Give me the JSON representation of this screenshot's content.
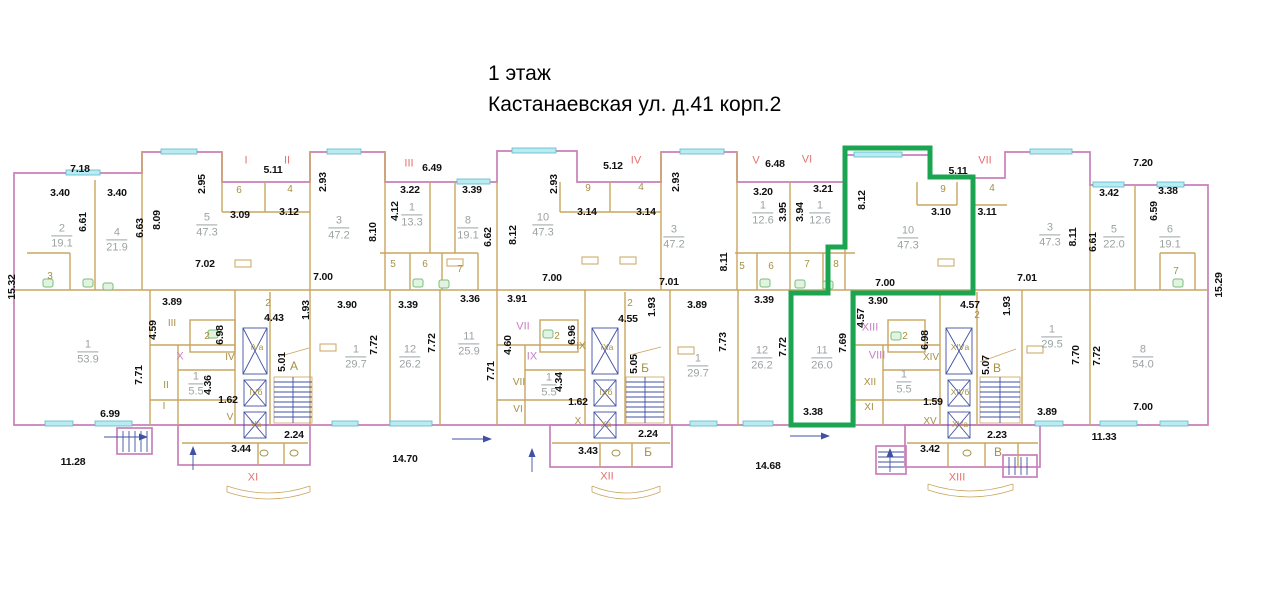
{
  "title": {
    "line1": "1 этаж",
    "line2": "Кастанаевская ул. д.41 корп.2"
  },
  "colors": {
    "outer_wall": "#c97fb9",
    "inner_wall": "#c9a55f",
    "window_fill": "#b8ecf2",
    "window_stroke": "#5fb7c8",
    "highlight": "#1ba551",
    "dim_text": "#111111",
    "room_text": "#9ba3a3",
    "olive_text": "#a59043",
    "red_text": "#e4716f",
    "mag_text": "#c77fc7",
    "blue": "#3f51a3",
    "fixture": "#7bbf7b"
  },
  "plan": {
    "labels": [
      {
        "c": "d",
        "t": "7.18",
        "x": 80,
        "y": 169
      },
      {
        "c": "d",
        "t": "3.40",
        "x": 60,
        "y": 193
      },
      {
        "c": "d",
        "t": "3.40",
        "x": 117,
        "y": 193
      },
      {
        "c": "d",
        "t": "6.61",
        "x": 83,
        "y": 222,
        "v": 1
      },
      {
        "c": "d",
        "t": "6.63",
        "x": 140,
        "y": 228,
        "v": 1
      },
      {
        "c": "d",
        "t": "8.09",
        "x": 157,
        "y": 220,
        "v": 1
      },
      {
        "c": "d",
        "t": "2.95",
        "x": 202,
        "y": 184,
        "v": 1
      },
      {
        "c": "d",
        "t": "3.09",
        "x": 240,
        "y": 215
      },
      {
        "c": "d",
        "t": "5.11",
        "x": 273,
        "y": 170
      },
      {
        "c": "d",
        "t": "3.12",
        "x": 289,
        "y": 212
      },
      {
        "c": "d",
        "t": "2.93",
        "x": 323,
        "y": 182,
        "v": 1
      },
      {
        "c": "d",
        "t": "8.10",
        "x": 373,
        "y": 232,
        "v": 1
      },
      {
        "c": "d",
        "t": "7.02",
        "x": 205,
        "y": 264
      },
      {
        "c": "d",
        "t": "7.00",
        "x": 323,
        "y": 277
      },
      {
        "c": "d",
        "t": "6.49",
        "x": 432,
        "y": 168
      },
      {
        "c": "d",
        "t": "3.22",
        "x": 410,
        "y": 190
      },
      {
        "c": "d",
        "t": "4.12",
        "x": 395,
        "y": 211,
        "v": 1
      },
      {
        "c": "d",
        "t": "3.39",
        "x": 472,
        "y": 190
      },
      {
        "c": "d",
        "t": "6.62",
        "x": 488,
        "y": 237,
        "v": 1
      },
      {
        "c": "d",
        "t": "8.12",
        "x": 513,
        "y": 235,
        "v": 1
      },
      {
        "c": "d",
        "t": "5.12",
        "x": 613,
        "y": 166
      },
      {
        "c": "d",
        "t": "2.93",
        "x": 554,
        "y": 184,
        "v": 1
      },
      {
        "c": "d",
        "t": "3.14",
        "x": 587,
        "y": 212
      },
      {
        "c": "d",
        "t": "3.14",
        "x": 646,
        "y": 212
      },
      {
        "c": "d",
        "t": "7.00",
        "x": 552,
        "y": 278
      },
      {
        "c": "d",
        "t": "2.93",
        "x": 676,
        "y": 182,
        "v": 1
      },
      {
        "c": "d",
        "t": "7.01",
        "x": 669,
        "y": 282
      },
      {
        "c": "d",
        "t": "8.11",
        "x": 724,
        "y": 262,
        "v": 1
      },
      {
        "c": "d",
        "t": "6.48",
        "x": 775,
        "y": 164
      },
      {
        "c": "d",
        "t": "3.20",
        "x": 763,
        "y": 192
      },
      {
        "c": "d",
        "t": "3.21",
        "x": 823,
        "y": 189
      },
      {
        "c": "d",
        "t": "3.95",
        "x": 783,
        "y": 212,
        "v": 1
      },
      {
        "c": "d",
        "t": "3.94",
        "x": 800,
        "y": 212,
        "v": 1
      },
      {
        "c": "d",
        "t": "8.12",
        "x": 862,
        "y": 200,
        "v": 1
      },
      {
        "c": "d",
        "t": "5.11",
        "x": 958,
        "y": 171
      },
      {
        "c": "d",
        "t": "3.10",
        "x": 941,
        "y": 212
      },
      {
        "c": "d",
        "t": "3.11",
        "x": 987,
        "y": 212
      },
      {
        "c": "d",
        "t": "7.00",
        "x": 885,
        "y": 283
      },
      {
        "c": "d",
        "t": "7.20",
        "x": 1143,
        "y": 163
      },
      {
        "c": "d",
        "t": "3.42",
        "x": 1109,
        "y": 193
      },
      {
        "c": "d",
        "t": "3.38",
        "x": 1168,
        "y": 191
      },
      {
        "c": "d",
        "t": "6.61",
        "x": 1093,
        "y": 242,
        "v": 1
      },
      {
        "c": "d",
        "t": "8.11",
        "x": 1073,
        "y": 237,
        "v": 1
      },
      {
        "c": "d",
        "t": "6.59",
        "x": 1154,
        "y": 211,
        "v": 1
      },
      {
        "c": "d",
        "t": "7.01",
        "x": 1027,
        "y": 278
      },
      {
        "c": "d",
        "t": "15.32",
        "x": 12,
        "y": 287,
        "v": 1
      },
      {
        "c": "d",
        "t": "15.29",
        "x": 1219,
        "y": 285,
        "v": 1
      },
      {
        "c": "d",
        "t": "3.89",
        "x": 172,
        "y": 302
      },
      {
        "c": "d",
        "t": "4.59",
        "x": 153,
        "y": 330,
        "v": 1
      },
      {
        "c": "d",
        "t": "7.71",
        "x": 139,
        "y": 375,
        "v": 1
      },
      {
        "c": "d",
        "t": "6.99",
        "x": 110,
        "y": 414
      },
      {
        "c": "d",
        "t": "11.28",
        "x": 73,
        "y": 462
      },
      {
        "c": "d",
        "t": "6.98",
        "x": 220,
        "y": 335,
        "v": 1
      },
      {
        "c": "d",
        "t": "4.36",
        "x": 208,
        "y": 385,
        "v": 1
      },
      {
        "c": "d",
        "t": "1.62",
        "x": 228,
        "y": 400
      },
      {
        "c": "d",
        "t": "3.44",
        "x": 241,
        "y": 449
      },
      {
        "c": "d",
        "t": "4.43",
        "x": 274,
        "y": 318
      },
      {
        "c": "d",
        "t": "1.93",
        "x": 306,
        "y": 310,
        "v": 1
      },
      {
        "c": "d",
        "t": "5.01",
        "x": 282,
        "y": 362,
        "v": 1
      },
      {
        "c": "d",
        "t": "2.24",
        "x": 294,
        "y": 435
      },
      {
        "c": "d",
        "t": "3.90",
        "x": 347,
        "y": 305
      },
      {
        "c": "d",
        "t": "7.72",
        "x": 374,
        "y": 345,
        "v": 1
      },
      {
        "c": "d",
        "t": "3.39",
        "x": 408,
        "y": 305
      },
      {
        "c": "d",
        "t": "7.72",
        "x": 432,
        "y": 343,
        "v": 1
      },
      {
        "c": "d",
        "t": "14.70",
        "x": 405,
        "y": 459
      },
      {
        "c": "d",
        "t": "3.36",
        "x": 470,
        "y": 299
      },
      {
        "c": "d",
        "t": "3.91",
        "x": 517,
        "y": 299
      },
      {
        "c": "d",
        "t": "7.71",
        "x": 491,
        "y": 371,
        "v": 1
      },
      {
        "c": "d",
        "t": "4.60",
        "x": 508,
        "y": 345,
        "v": 1
      },
      {
        "c": "d",
        "t": "4.34",
        "x": 559,
        "y": 382,
        "v": 1
      },
      {
        "c": "d",
        "t": "6.96",
        "x": 572,
        "y": 335,
        "v": 1
      },
      {
        "c": "d",
        "t": "1.62",
        "x": 578,
        "y": 402
      },
      {
        "c": "d",
        "t": "5.05",
        "x": 634,
        "y": 364,
        "v": 1
      },
      {
        "c": "d",
        "t": "4.55",
        "x": 628,
        "y": 319
      },
      {
        "c": "d",
        "t": "1.93",
        "x": 652,
        "y": 307,
        "v": 1
      },
      {
        "c": "d",
        "t": "2.24",
        "x": 648,
        "y": 434
      },
      {
        "c": "d",
        "t": "3.43",
        "x": 588,
        "y": 451
      },
      {
        "c": "d",
        "t": "3.89",
        "x": 697,
        "y": 305
      },
      {
        "c": "d",
        "t": "7.73",
        "x": 723,
        "y": 342,
        "v": 1
      },
      {
        "c": "d",
        "t": "3.39",
        "x": 764,
        "y": 300
      },
      {
        "c": "d",
        "t": "7.72",
        "x": 783,
        "y": 347,
        "v": 1
      },
      {
        "c": "d",
        "t": "7.69",
        "x": 843,
        "y": 343,
        "v": 1
      },
      {
        "c": "d",
        "t": "3.38",
        "x": 813,
        "y": 412
      },
      {
        "c": "d",
        "t": "3.90",
        "x": 878,
        "y": 301
      },
      {
        "c": "d",
        "t": "4.57",
        "x": 861,
        "y": 318,
        "v": 1
      },
      {
        "c": "d",
        "t": "6.98",
        "x": 925,
        "y": 340,
        "v": 1
      },
      {
        "c": "d",
        "t": "1.59",
        "x": 933,
        "y": 402
      },
      {
        "c": "d",
        "t": "3.42",
        "x": 930,
        "y": 449
      },
      {
        "c": "d",
        "t": "5.07",
        "x": 986,
        "y": 365,
        "v": 1
      },
      {
        "c": "d",
        "t": "2.23",
        "x": 997,
        "y": 435
      },
      {
        "c": "d",
        "t": "4.57",
        "x": 970,
        "y": 305
      },
      {
        "c": "d",
        "t": "1.93",
        "x": 1007,
        "y": 306,
        "v": 1
      },
      {
        "c": "d",
        "t": "3.89",
        "x": 1047,
        "y": 412
      },
      {
        "c": "d",
        "t": "7.70",
        "x": 1076,
        "y": 355,
        "v": 1
      },
      {
        "c": "d",
        "t": "7.72",
        "x": 1097,
        "y": 356,
        "v": 1
      },
      {
        "c": "d",
        "t": "7.00",
        "x": 1143,
        "y": 407
      },
      {
        "c": "d",
        "t": "11.33",
        "x": 1104,
        "y": 437
      },
      {
        "c": "d",
        "t": "14.68",
        "x": 768,
        "y": 466
      },
      {
        "c": "r",
        "n": "2",
        "a": "19.1",
        "x": 62,
        "y": 236
      },
      {
        "c": "r",
        "n": "4",
        "a": "21.9",
        "x": 117,
        "y": 240
      },
      {
        "c": "r",
        "n": "5",
        "a": "47.3",
        "x": 207,
        "y": 225
      },
      {
        "c": "r",
        "n": "3",
        "a": "47.2",
        "x": 339,
        "y": 228
      },
      {
        "c": "r",
        "n": "1",
        "a": "13.3",
        "x": 412,
        "y": 215
      },
      {
        "c": "r",
        "n": "8",
        "a": "19.1",
        "x": 468,
        "y": 228
      },
      {
        "c": "r",
        "n": "10",
        "a": "47.3",
        "x": 543,
        "y": 225
      },
      {
        "c": "r",
        "n": "3",
        "a": "47.2",
        "x": 674,
        "y": 237
      },
      {
        "c": "r",
        "n": "1",
        "a": "12.6",
        "x": 763,
        "y": 213
      },
      {
        "c": "r",
        "n": "1",
        "a": "12.6",
        "x": 820,
        "y": 213
      },
      {
        "c": "r",
        "n": "10",
        "a": "47.3",
        "x": 908,
        "y": 238
      },
      {
        "c": "r",
        "n": "3",
        "a": "47.3",
        "x": 1050,
        "y": 235
      },
      {
        "c": "r",
        "n": "5",
        "a": "22.0",
        "x": 1114,
        "y": 237
      },
      {
        "c": "r",
        "n": "6",
        "a": "19.1",
        "x": 1170,
        "y": 237
      },
      {
        "c": "r",
        "n": "1",
        "a": "53.9",
        "x": 88,
        "y": 352
      },
      {
        "c": "r",
        "n": "1",
        "a": "5.5",
        "x": 196,
        "y": 384
      },
      {
        "c": "r",
        "n": "1",
        "a": "29.7",
        "x": 356,
        "y": 357
      },
      {
        "c": "r",
        "n": "12",
        "a": "26.2",
        "x": 410,
        "y": 357
      },
      {
        "c": "r",
        "n": "11",
        "a": "25.9",
        "x": 469,
        "y": 344
      },
      {
        "c": "r",
        "n": "1",
        "a": "5.5",
        "x": 549,
        "y": 385
      },
      {
        "c": "r",
        "n": "1",
        "a": "29.7",
        "x": 698,
        "y": 366
      },
      {
        "c": "r",
        "n": "12",
        "a": "26.2",
        "x": 762,
        "y": 358
      },
      {
        "c": "r",
        "n": "11",
        "a": "26.0",
        "x": 822,
        "y": 358
      },
      {
        "c": "r",
        "n": "1",
        "a": "5.5",
        "x": 904,
        "y": 382
      },
      {
        "c": "r",
        "n": "1",
        "a": "29.5",
        "x": 1052,
        "y": 337
      },
      {
        "c": "r",
        "n": "8",
        "a": "54.0",
        "x": 1143,
        "y": 357
      },
      {
        "c": "s",
        "t": "6",
        "x": 239,
        "y": 191
      },
      {
        "c": "s",
        "t": "4",
        "x": 290,
        "y": 190
      },
      {
        "c": "s",
        "t": "3",
        "x": 50,
        "y": 277
      },
      {
        "c": "s",
        "t": "5",
        "x": 393,
        "y": 265
      },
      {
        "c": "s",
        "t": "6",
        "x": 425,
        "y": 265
      },
      {
        "c": "s",
        "t": "7",
        "x": 460,
        "y": 270
      },
      {
        "c": "s",
        "t": "9",
        "x": 588,
        "y": 189
      },
      {
        "c": "s",
        "t": "4",
        "x": 641,
        "y": 188
      },
      {
        "c": "s",
        "t": "5",
        "x": 742,
        "y": 267
      },
      {
        "c": "s",
        "t": "6",
        "x": 771,
        "y": 267
      },
      {
        "c": "s",
        "t": "7",
        "x": 807,
        "y": 265
      },
      {
        "c": "s",
        "t": "8",
        "x": 836,
        "y": 265
      },
      {
        "c": "s",
        "t": "9",
        "x": 943,
        "y": 190
      },
      {
        "c": "s",
        "t": "4",
        "x": 992,
        "y": 189
      },
      {
        "c": "s",
        "t": "7",
        "x": 1176,
        "y": 272
      },
      {
        "c": "s",
        "t": "2",
        "x": 207,
        "y": 337
      },
      {
        "c": "s",
        "t": "2",
        "x": 268,
        "y": 304
      },
      {
        "c": "s",
        "t": "2",
        "x": 557,
        "y": 337
      },
      {
        "c": "s",
        "t": "2",
        "x": 630,
        "y": 304
      },
      {
        "c": "s",
        "t": "2",
        "x": 905,
        "y": 337
      },
      {
        "c": "s",
        "t": "2",
        "x": 977,
        "y": 316
      },
      {
        "c": "s",
        "t": "III",
        "x": 172,
        "y": 324
      },
      {
        "c": "s",
        "t": "II",
        "x": 166,
        "y": 386
      },
      {
        "c": "s",
        "t": "I",
        "x": 164,
        "y": 407
      },
      {
        "c": "s",
        "t": "IV",
        "x": 230,
        "y": 358
      },
      {
        "c": "s",
        "t": "V",
        "x": 230,
        "y": 418
      },
      {
        "c": "s",
        "t": "VII",
        "x": 519,
        "y": 383
      },
      {
        "c": "s",
        "t": "VI",
        "x": 518,
        "y": 410
      },
      {
        "c": "s",
        "t": "IX",
        "x": 581,
        "y": 347
      },
      {
        "c": "s",
        "t": "X",
        "x": 578,
        "y": 422
      },
      {
        "c": "s",
        "t": "XII",
        "x": 870,
        "y": 383
      },
      {
        "c": "s",
        "t": "XI",
        "x": 869,
        "y": 408
      },
      {
        "c": "s",
        "t": "XIV",
        "x": 931,
        "y": 358
      },
      {
        "c": "s",
        "t": "XV",
        "x": 930,
        "y": 422
      },
      {
        "c": "st",
        "t": "А",
        "x": 294,
        "y": 366
      },
      {
        "c": "st",
        "t": "Б",
        "x": 645,
        "y": 368
      },
      {
        "c": "st",
        "t": "Б",
        "x": 648,
        "y": 452
      },
      {
        "c": "st",
        "t": "В",
        "x": 997,
        "y": 368
      },
      {
        "c": "st",
        "t": "В",
        "x": 998,
        "y": 452
      },
      {
        "c": "sh",
        "t": "IVа",
        "x": 257,
        "y": 347
      },
      {
        "c": "sh",
        "t": "IVб",
        "x": 256,
        "y": 392
      },
      {
        "c": "sh",
        "t": "Vа",
        "x": 256,
        "y": 424
      },
      {
        "c": "sh",
        "t": "IXа",
        "x": 607,
        "y": 347
      },
      {
        "c": "sh",
        "t": "IXб",
        "x": 606,
        "y": 392
      },
      {
        "c": "sh",
        "t": "Xа",
        "x": 606,
        "y": 424
      },
      {
        "c": "sh",
        "t": "XIVа",
        "x": 960,
        "y": 347
      },
      {
        "c": "sh",
        "t": "XIVб",
        "x": 960,
        "y": 392
      },
      {
        "c": "sh",
        "t": "XVа",
        "x": 960,
        "y": 424
      },
      {
        "c": "rr",
        "t": "I",
        "x": 246,
        "y": 161
      },
      {
        "c": "rr",
        "t": "II",
        "x": 287,
        "y": 161
      },
      {
        "c": "rr",
        "t": "III",
        "x": 409,
        "y": 164
      },
      {
        "c": "rr",
        "t": "IV",
        "x": 636,
        "y": 161
      },
      {
        "c": "rr",
        "t": "V",
        "x": 756,
        "y": 161
      },
      {
        "c": "rr",
        "t": "VI",
        "x": 807,
        "y": 160
      },
      {
        "c": "rr",
        "t": "VII",
        "x": 985,
        "y": 161
      },
      {
        "c": "rr",
        "t": "XI",
        "x": 253,
        "y": 478
      },
      {
        "c": "rr",
        "t": "XII",
        "x": 607,
        "y": 477
      },
      {
        "c": "rr",
        "t": "XIII",
        "x": 957,
        "y": 478
      },
      {
        "c": "m",
        "t": "X",
        "x": 180,
        "y": 357
      },
      {
        "c": "m",
        "t": "VII",
        "x": 523,
        "y": 327
      },
      {
        "c": "m",
        "t": "IX",
        "x": 532,
        "y": 357
      },
      {
        "c": "m",
        "t": "XIII",
        "x": 870,
        "y": 328
      },
      {
        "c": "m",
        "t": "VIII",
        "x": 877,
        "y": 356
      }
    ]
  },
  "highlight_apartment": {
    "outline_points": "845,148 930,148 930,177 973,177 973,293 853,293 853,425 791,425 791,293 828,293 828,247 845,247"
  }
}
